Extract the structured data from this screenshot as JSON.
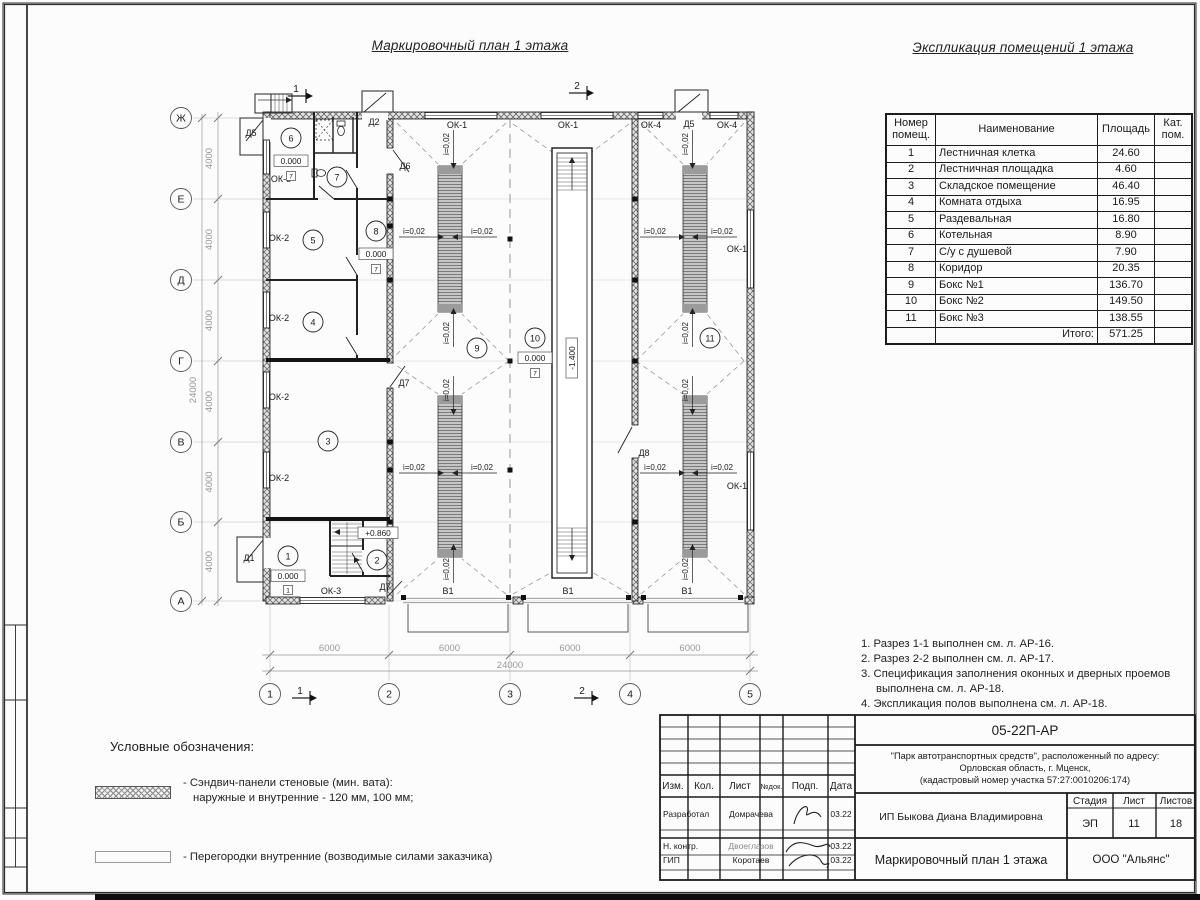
{
  "sheet": {
    "plan_title": "Маркировочный план 1 этажа",
    "table_title": "Экспликация помещений 1 этажа"
  },
  "explication": {
    "headers": {
      "num": "Номер помещ.",
      "name": "Наименование",
      "area": "Площадь",
      "cat": "Кат. пом."
    },
    "rows": [
      [
        "1",
        "Лестничная клетка",
        "24.60"
      ],
      [
        "2",
        "Лестничная площадка",
        "4.60"
      ],
      [
        "3",
        "Складское помещение",
        "46.40"
      ],
      [
        "4",
        "Комната отдыха",
        "16.95"
      ],
      [
        "5",
        "Раздевальная",
        "16.80"
      ],
      [
        "6",
        "Котельная",
        "8.90"
      ],
      [
        "7",
        "С/у с душевой",
        "7.90"
      ],
      [
        "8",
        "Коридор",
        "20.35"
      ],
      [
        "9",
        "Бокс №1",
        "136.70"
      ],
      [
        "10",
        "Бокс №2",
        "149.50"
      ],
      [
        "11",
        "Бокс №3",
        "138.55"
      ]
    ],
    "total_label": "Итого:",
    "total_value": "571.25"
  },
  "notes": [
    "1. Разрез 1-1 выполнен см. л. АР-16.",
    "2. Разрез 2-2 выполнен см. л. АР-17.",
    "3. Спецификация заполнения оконных и дверных проемов выполнена см. л. АР-18.",
    "4. Экспликация полов выполнена см. л. АР-18."
  ],
  "legend": {
    "title": "Условные обозначения:",
    "sandwich_line1": "- Сэндвич-панели стеновые (мин. вата):",
    "sandwich_line2": "наружные и внутренние - 120 мм, 100 мм;",
    "partition_text": "- Перегородки внутренние (возводимые силами заказчика)"
  },
  "titleblock": {
    "doc_number": "05-22П-АР",
    "project_lines": [
      "\"Парк автотранспортных средств\",  расположенный по адресу:",
      "Орловская область, г. Мценск,",
      "(кадастровый номер участка 57:27:0010206:174)"
    ],
    "client": "ИП Быкова Диана Владимировна",
    "sheet_title": "Маркировочный план 1 этажа",
    "company": "ООО \"Альянс\"",
    "stage_label": "Стадия",
    "stage_value": "ЭП",
    "sheet_label": "Лист",
    "sheet_value": "11",
    "sheets_label": "Листов",
    "sheets_value": "18",
    "columns": [
      "Изм.",
      "Кол.",
      "Лист",
      "№док.",
      "Подп.",
      "Дата"
    ],
    "signature_rows": [
      {
        "role": "Разработал",
        "name": "Домрачева",
        "date": "03.22"
      },
      {
        "role": "Н. контр.",
        "name": "Двоеглазов",
        "date": "03.22"
      },
      {
        "role": "ГИП",
        "name": "Коротаев",
        "date": "03.22"
      }
    ]
  },
  "plan": {
    "grid_rows": [
      {
        "l": "Ж",
        "y": 118
      },
      {
        "l": "Е",
        "y": 199
      },
      {
        "l": "Д",
        "y": 280
      },
      {
        "l": "Г",
        "y": 361
      },
      {
        "l": "В",
        "y": 442
      },
      {
        "l": "Б",
        "y": 522
      },
      {
        "l": "А",
        "y": 601
      }
    ],
    "grid_cols": [
      {
        "l": "1",
        "x": 270
      },
      {
        "l": "2",
        "x": 389
      },
      {
        "l": "3",
        "x": 510
      },
      {
        "l": "4",
        "x": 630
      },
      {
        "l": "5",
        "x": 750
      }
    ],
    "dim_v": "4000",
    "dim_v_total": "24000",
    "dim_h": "6000",
    "dim_h_total": "24000",
    "slope_label": "i=0,02",
    "marks": [
      {
        "t": "ОК-1",
        "x": 457,
        "y": 128
      },
      {
        "t": "ОК-1",
        "x": 568,
        "y": 128
      },
      {
        "t": "ОК-4",
        "x": 651,
        "y": 128
      },
      {
        "t": "Д5",
        "x": 689,
        "y": 127
      },
      {
        "t": "ОК-4",
        "x": 727,
        "y": 128
      },
      {
        "t": "Д5",
        "x": 251,
        "y": 136
      },
      {
        "t": "Д2",
        "x": 374,
        "y": 125
      },
      {
        "t": "Д6",
        "x": 405,
        "y": 169
      },
      {
        "t": "ОК-5",
        "x": 281,
        "y": 182
      },
      {
        "t": "ОК-2",
        "x": 279,
        "y": 241
      },
      {
        "t": "ОК-2",
        "x": 279,
        "y": 321
      },
      {
        "t": "ОК-2",
        "x": 279,
        "y": 400
      },
      {
        "t": "ОК-2",
        "x": 279,
        "y": 481
      },
      {
        "t": "Д7",
        "x": 404,
        "y": 386
      },
      {
        "t": "Д8",
        "x": 644,
        "y": 456
      },
      {
        "t": "Д1",
        "x": 249,
        "y": 561
      },
      {
        "t": "ОК-3",
        "x": 331,
        "y": 594
      },
      {
        "t": "Д7",
        "x": 385,
        "y": 590
      },
      {
        "t": "В1",
        "x": 448,
        "y": 594
      },
      {
        "t": "В1",
        "x": 568,
        "y": 594
      },
      {
        "t": "В1",
        "x": 687,
        "y": 594
      },
      {
        "t": "ОК-1",
        "x": 737,
        "y": 252
      },
      {
        "t": "ОК-1",
        "x": 737,
        "y": 489
      }
    ],
    "slopes": [
      {
        "x": 414,
        "y": 234,
        "d": "r"
      },
      {
        "x": 482,
        "y": 234,
        "d": "l"
      },
      {
        "x": 414,
        "y": 470,
        "d": "r"
      },
      {
        "x": 482,
        "y": 470,
        "d": "l"
      },
      {
        "x": 655,
        "y": 234,
        "d": "r"
      },
      {
        "x": 722,
        "y": 234,
        "d": "l"
      },
      {
        "x": 655,
        "y": 470,
        "d": "r"
      },
      {
        "x": 722,
        "y": 470,
        "d": "l"
      },
      {
        "x": 449,
        "y": 144,
        "d": "d",
        "v": true
      },
      {
        "x": 688,
        "y": 144,
        "d": "d",
        "v": true
      },
      {
        "x": 449,
        "y": 333,
        "d": "u",
        "v": true
      },
      {
        "x": 688,
        "y": 333,
        "d": "u",
        "v": true
      },
      {
        "x": 449,
        "y": 390,
        "d": "d",
        "v": true
      },
      {
        "x": 688,
        "y": 390,
        "d": "d",
        "v": true
      },
      {
        "x": 449,
        "y": 569,
        "d": "u",
        "v": true
      },
      {
        "x": 688,
        "y": 569,
        "d": "u",
        "v": true
      }
    ],
    "rooms": [
      {
        "n": "1",
        "x": 288,
        "y": 556
      },
      {
        "n": "2",
        "x": 377,
        "y": 560
      },
      {
        "n": "3",
        "x": 328,
        "y": 441
      },
      {
        "n": "4",
        "x": 313,
        "y": 322
      },
      {
        "n": "5",
        "x": 313,
        "y": 240
      },
      {
        "n": "6",
        "x": 291,
        "y": 138
      },
      {
        "n": "7",
        "x": 337,
        "y": 177
      },
      {
        "n": "8",
        "x": 376,
        "y": 231
      },
      {
        "n": "9",
        "x": 477,
        "y": 348
      },
      {
        "n": "10",
        "x": 535,
        "y": 338
      },
      {
        "n": "11",
        "x": 710,
        "y": 338
      }
    ],
    "elevations": [
      {
        "v": "0.000",
        "x": 291,
        "y": 161
      },
      {
        "v": "0.000",
        "x": 376,
        "y": 254
      },
      {
        "v": "0.000",
        "x": 288,
        "y": 576
      },
      {
        "v": "0.000",
        "x": 535,
        "y": 358
      },
      {
        "v": "+0.860",
        "x": 378,
        "y": 533
      },
      {
        "v": "-1.400",
        "x": 572,
        "y": 358,
        "rot": true
      }
    ],
    "floor_marks": [
      {
        "v": "7",
        "x": 291,
        "y": 176
      },
      {
        "v": "7",
        "x": 376,
        "y": 269
      },
      {
        "v": "1",
        "x": 288,
        "y": 590
      },
      {
        "v": "7",
        "x": 535,
        "y": 373
      }
    ],
    "section_marks": [
      {
        "l": "1",
        "tx": 296,
        "ty": 89,
        "bx": 300,
        "by": 691
      },
      {
        "l": "2",
        "tx": 577,
        "ty": 86,
        "bx": 582,
        "by": 691
      }
    ]
  }
}
